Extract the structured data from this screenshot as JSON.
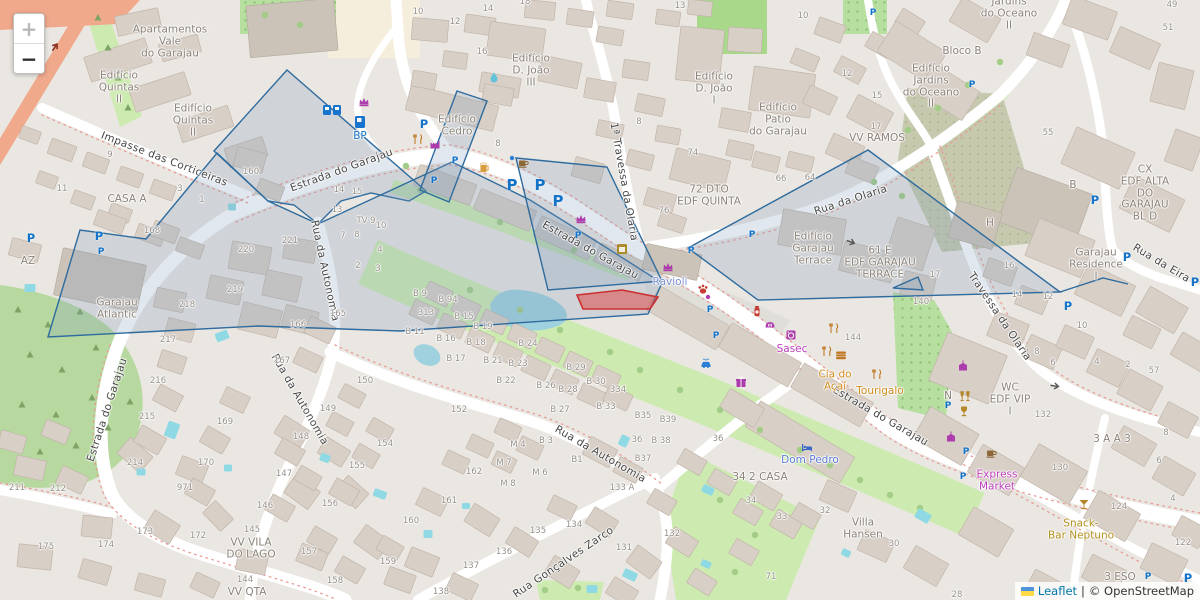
{
  "attribution": {
    "leaflet_label": "Leaflet",
    "separator": "|",
    "copyright_label": "© OpenStreetMap",
    "flag": "ukraine-flag-icon"
  },
  "zoom_control": {
    "zoom_in_label": "+",
    "zoom_out_label": "−"
  },
  "colors": {
    "street_text": "#454545",
    "building_text": "#8b8278",
    "number_text": "#97908a",
    "parking_blue": "#1273c9",
    "overlay_stroke": "#2e6b9e",
    "overlay_fill": "#7f9bb8",
    "highlight_red": "#cc2f2f",
    "water": "#8ed9e4",
    "green": "#cdebb0",
    "forest": "#b7d9a0",
    "road_orange": "#f1a98c",
    "shop_purple": "#ad3dad",
    "food_orange": "#cf8a1c",
    "bar_gold": "#b5872a",
    "health_red": "#c63c32"
  },
  "streets": [
    [
      "Estrada do Garajau",
      342,
      171,
      -20
    ],
    [
      "Estrada do Garajau",
      590,
      251,
      29
    ],
    [
      "Estrada do Garajau",
      880,
      417,
      30
    ],
    [
      "Estrada do Garajau",
      108,
      410,
      -72
    ],
    [
      "Impasse das Corticeiras",
      164,
      160,
      21
    ],
    [
      "Rua da Autonomia",
      324,
      271,
      78
    ],
    [
      "Rua da Autonomia",
      299,
      400,
      60
    ],
    [
      "Rua da Autonomia",
      600,
      455,
      30
    ],
    [
      "Rua Gonçalves Zarco",
      564,
      563,
      -34
    ],
    [
      "Rua da Olaria",
      851,
      201,
      -18
    ],
    [
      "Rua da Eira",
      1161,
      264,
      31
    ],
    [
      "1ª Travessa da Olaria",
      623,
      182,
      80
    ],
    [
      "Travessa da Olaria",
      999,
      317,
      56
    ]
  ],
  "building_labels": [
    [
      "Apartamentos\nVale\ndo Garajau",
      170,
      42
    ],
    [
      "Edifício\nQuintas\nII",
      119,
      88
    ],
    [
      "Edifício\nQuintas\nII",
      193,
      121
    ],
    [
      "CASA A",
      127,
      200
    ],
    [
      "Edifício\nCedro",
      457,
      126
    ],
    [
      "Edifício\nD. João\nIII",
      531,
      71
    ],
    [
      "Edifício\nD. João\nI",
      714,
      89
    ],
    [
      "Edifício\nPatio\ndo Garajau",
      778,
      120
    ],
    [
      "Edifício\nJardins\ndo Oceano\nII",
      931,
      87
    ],
    [
      "Jardins\ndo Oceano\nII",
      1009,
      14
    ],
    [
      "Bloco B",
      962,
      52
    ],
    [
      "VV RAMOS",
      877,
      139
    ],
    [
      "72 DTO\nEDF QUINTA",
      709,
      196
    ],
    [
      "Edifício\nGarajau\nTerrace",
      813,
      249
    ],
    [
      "61 E\nEDF GARAJAU\nTERRACE",
      880,
      263
    ],
    [
      "Garajau\nResidence\nI",
      1096,
      265
    ],
    [
      "CX\nEDF ALTA\nDO GARAJAU\nBL D",
      1145,
      194
    ],
    [
      "Garajau\nAtlantic",
      117,
      309
    ],
    [
      "AZ",
      28,
      262
    ],
    [
      "VV VILA\nDO LAGO",
      251,
      549
    ],
    [
      "VV QTA",
      247,
      593
    ],
    [
      "Villa\nHansen",
      863,
      529
    ],
    [
      "34 2 CASA",
      760,
      478
    ],
    [
      "WC\nEDF VIP\nI",
      1010,
      400
    ],
    [
      "3 ESO",
      1120,
      578
    ],
    [
      "3 A A 3",
      1112,
      440
    ],
    [
      "N",
      948,
      397
    ],
    [
      "H",
      990,
      224
    ],
    [
      "B",
      1073,
      186
    ]
  ],
  "house_numbers": [
    [
      "9",
      110,
      156
    ],
    [
      "11",
      62,
      190
    ],
    [
      "3",
      180,
      190
    ],
    [
      "1",
      202,
      201
    ],
    [
      "160",
      251,
      173
    ],
    [
      "168",
      152,
      232
    ],
    [
      "14",
      339,
      191
    ],
    [
      "15",
      357,
      193
    ],
    [
      "13",
      337,
      211
    ],
    [
      "TV 9",
      366,
      222
    ],
    [
      "10",
      381,
      227
    ],
    [
      "7",
      343,
      237
    ],
    [
      "8",
      357,
      236
    ],
    [
      "4",
      380,
      251
    ],
    [
      "2",
      358,
      267
    ],
    [
      "3",
      378,
      270
    ],
    [
      "220",
      246,
      251
    ],
    [
      "221",
      290,
      242
    ],
    [
      "219",
      235,
      291
    ],
    [
      "218",
      187,
      306
    ],
    [
      "217",
      168,
      341
    ],
    [
      "216",
      158,
      382
    ],
    [
      "166",
      298,
      326
    ],
    [
      "165",
      338,
      315
    ],
    [
      "167",
      282,
      362
    ],
    [
      "150",
      365,
      382
    ],
    [
      "149",
      328,
      410
    ],
    [
      "10",
      418,
      13
    ],
    [
      "12",
      455,
      23
    ],
    [
      "14",
      488,
      10
    ],
    [
      "16",
      482,
      53
    ],
    [
      "18",
      525,
      3
    ],
    [
      "13",
      680,
      7
    ],
    [
      "8",
      498,
      145
    ],
    [
      "8",
      639,
      123
    ],
    [
      "74",
      693,
      154
    ],
    [
      "66",
      781,
      180
    ],
    [
      "64",
      810,
      179
    ],
    [
      "76",
      664,
      212
    ],
    [
      "49",
      1172,
      6
    ],
    [
      "51",
      1168,
      29
    ],
    [
      "12",
      847,
      75
    ],
    [
      "15",
      877,
      97
    ],
    [
      "17",
      876,
      128
    ],
    [
      "10",
      803,
      17
    ],
    [
      "55",
      1048,
      134
    ],
    [
      "215",
      147,
      418
    ],
    [
      "169",
      225,
      423
    ],
    [
      "148",
      301,
      438
    ],
    [
      "214",
      135,
      464
    ],
    [
      "170",
      206,
      464
    ],
    [
      "971",
      185,
      489
    ],
    [
      "147",
      284,
      475
    ],
    [
      "211",
      17,
      489
    ],
    [
      "212",
      58,
      490
    ],
    [
      "146",
      265,
      507
    ],
    [
      "173",
      145,
      533
    ],
    [
      "172",
      198,
      537
    ],
    [
      "174",
      106,
      546
    ],
    [
      "175",
      46,
      548
    ],
    [
      "154",
      385,
      445
    ],
    [
      "155",
      357,
      467
    ],
    [
      "156",
      330,
      505
    ],
    [
      "157",
      309,
      553
    ],
    [
      "159",
      388,
      563
    ],
    [
      "158",
      335,
      582
    ],
    [
      "145",
      252,
      531
    ],
    [
      "144",
      245,
      581
    ],
    [
      "B 9",
      420,
      295
    ],
    [
      "B 94",
      448,
      301
    ],
    [
      "313",
      426,
      314
    ],
    [
      "B 15",
      464,
      318
    ],
    [
      "B 11",
      415,
      333
    ],
    [
      "B 16",
      446,
      340
    ],
    [
      "B 18",
      476,
      344
    ],
    [
      "B 17",
      456,
      360
    ],
    [
      "B 19",
      483,
      328
    ],
    [
      "B 21",
      493,
      362
    ],
    [
      "B 24",
      528,
      345
    ],
    [
      "B 23",
      518,
      365
    ],
    [
      "B 22",
      506,
      382
    ],
    [
      "B 29",
      576,
      369
    ],
    [
      "B 26",
      546,
      387
    ],
    [
      "B 28",
      568,
      391
    ],
    [
      "B 30",
      596,
      383
    ],
    [
      "334",
      618,
      391
    ],
    [
      "B 27",
      560,
      411
    ],
    [
      "B 33",
      606,
      408
    ],
    [
      "B35",
      643,
      417
    ],
    [
      "B39",
      668,
      421
    ],
    [
      "152",
      459,
      411
    ],
    [
      "M 4",
      518,
      446
    ],
    [
      "B 3",
      546,
      442
    ],
    [
      "36",
      637,
      441
    ],
    [
      "B 38",
      661,
      442
    ],
    [
      "B37",
      643,
      460
    ],
    [
      "36",
      718,
      440
    ],
    [
      "M 7",
      504,
      464
    ],
    [
      "162",
      474,
      473
    ],
    [
      "M 6",
      540,
      474
    ],
    [
      "B1",
      577,
      461
    ],
    [
      "M 8",
      508,
      485
    ],
    [
      "161",
      449,
      502
    ],
    [
      "133 A",
      622,
      489
    ],
    [
      "160",
      411,
      522
    ],
    [
      "135",
      538,
      532
    ],
    [
      "134",
      574,
      526
    ],
    [
      "34",
      751,
      502
    ],
    [
      "33",
      782,
      518
    ],
    [
      "136",
      504,
      553
    ],
    [
      "132",
      672,
      535
    ],
    [
      "131",
      624,
      549
    ],
    [
      "137",
      471,
      567
    ],
    [
      "138",
      441,
      593
    ],
    [
      "71",
      771,
      578
    ],
    [
      "132",
      1043,
      416
    ],
    [
      "8",
      1166,
      434
    ],
    [
      "6",
      1159,
      462
    ],
    [
      "130",
      1060,
      469
    ],
    [
      "124",
      1119,
      508
    ],
    [
      "4",
      1173,
      500
    ],
    [
      "122",
      1183,
      544
    ],
    [
      "32",
      825,
      512
    ],
    [
      "30",
      894,
      545
    ],
    [
      "28",
      957,
      596
    ],
    [
      "17",
      935,
      276
    ],
    [
      "140",
      921,
      303
    ],
    [
      "144",
      853,
      339
    ],
    [
      "16",
      1009,
      267
    ],
    [
      "14",
      1017,
      296
    ],
    [
      "12",
      1048,
      298
    ],
    [
      "10",
      1082,
      327
    ],
    [
      "8",
      1037,
      353
    ],
    [
      "6",
      1053,
      364
    ],
    [
      "4",
      1097,
      363
    ],
    [
      "2",
      1128,
      366
    ],
    [
      "57",
      1154,
      372
    ]
  ],
  "poi_labels": [
    [
      "BP",
      360,
      137,
      "#1673c9"
    ],
    [
      "Ravioli",
      670,
      283,
      "#7b90cf"
    ],
    [
      "Dom Pedro",
      810,
      461,
      "#5b7bd4"
    ],
    [
      "Sasec",
      792,
      350,
      "#bb3ebb"
    ],
    [
      "Cia do\nAçaí",
      835,
      381,
      "#cf8a1c"
    ],
    [
      "Tourigalo",
      880,
      392,
      "#cf8a1c"
    ],
    [
      "Express\nMarket",
      997,
      481,
      "#bb3ebb"
    ],
    [
      "Snack-\nBar Neptuno",
      1081,
      530,
      "#b3901e"
    ]
  ],
  "parking_markers": [
    [
      31,
      238,
      "m"
    ],
    [
      99,
      236,
      "m"
    ],
    [
      101,
      252,
      "s"
    ],
    [
      424,
      124,
      "m"
    ],
    [
      434,
      181,
      "s"
    ],
    [
      455,
      161,
      "s"
    ],
    [
      512,
      185,
      "b"
    ],
    [
      540,
      185,
      "b"
    ],
    [
      558,
      201,
      "b"
    ],
    [
      578,
      236,
      "s"
    ],
    [
      691,
      251,
      "s"
    ],
    [
      710,
      310,
      "s"
    ],
    [
      716,
      336,
      "s"
    ],
    [
      752,
      235,
      "s"
    ],
    [
      873,
      13,
      "s"
    ],
    [
      972,
      85,
      "s"
    ],
    [
      948,
      406,
      "s"
    ],
    [
      966,
      452,
      "s"
    ],
    [
      963,
      477,
      "s"
    ],
    [
      1068,
      306,
      "m"
    ],
    [
      1095,
      200,
      "m"
    ],
    [
      1127,
      257,
      "m"
    ],
    [
      1195,
      282,
      "m"
    ],
    [
      1148,
      577,
      "s"
    ],
    [
      1188,
      578,
      "m"
    ]
  ],
  "poi_icons": [
    [
      "meter",
      327,
      110
    ],
    [
      "meter",
      337,
      110
    ],
    [
      "fuel",
      360,
      122
    ],
    [
      "crown",
      364,
      101
    ],
    [
      "crown",
      581,
      218
    ],
    [
      "crown",
      668,
      266
    ],
    [
      "fork",
      418,
      139
    ],
    [
      "factory",
      435,
      144
    ],
    [
      "beer",
      484,
      167
    ],
    [
      "dotb",
      512,
      158
    ],
    [
      "coffee",
      523,
      163
    ],
    [
      "drop",
      494,
      77
    ],
    [
      "kiosk",
      622,
      249
    ],
    [
      "paw",
      703,
      289
    ],
    [
      "dotp",
      708,
      297
    ],
    [
      "pharmacy",
      757,
      311
    ],
    [
      "bread",
      770,
      324
    ],
    [
      "laundry",
      791,
      335
    ],
    [
      "fork",
      834,
      328
    ],
    [
      "fork",
      827,
      351
    ],
    [
      "burger",
      841,
      355
    ],
    [
      "fork",
      877,
      374
    ],
    [
      "carwash",
      706,
      363
    ],
    [
      "gift",
      741,
      382
    ],
    [
      "hotel",
      807,
      447
    ],
    [
      "clothes",
      963,
      366
    ],
    [
      "glasses",
      965,
      396
    ],
    [
      "goblet",
      964,
      411
    ],
    [
      "clothes",
      951,
      437
    ],
    [
      "coffee",
      991,
      453
    ],
    [
      "cocktail",
      1084,
      504
    ]
  ],
  "arrows": [
    [
      851,
      242,
      20,
      "grey"
    ],
    [
      1055,
      386,
      8,
      "grey"
    ],
    [
      55,
      47,
      -55,
      "red"
    ]
  ]
}
